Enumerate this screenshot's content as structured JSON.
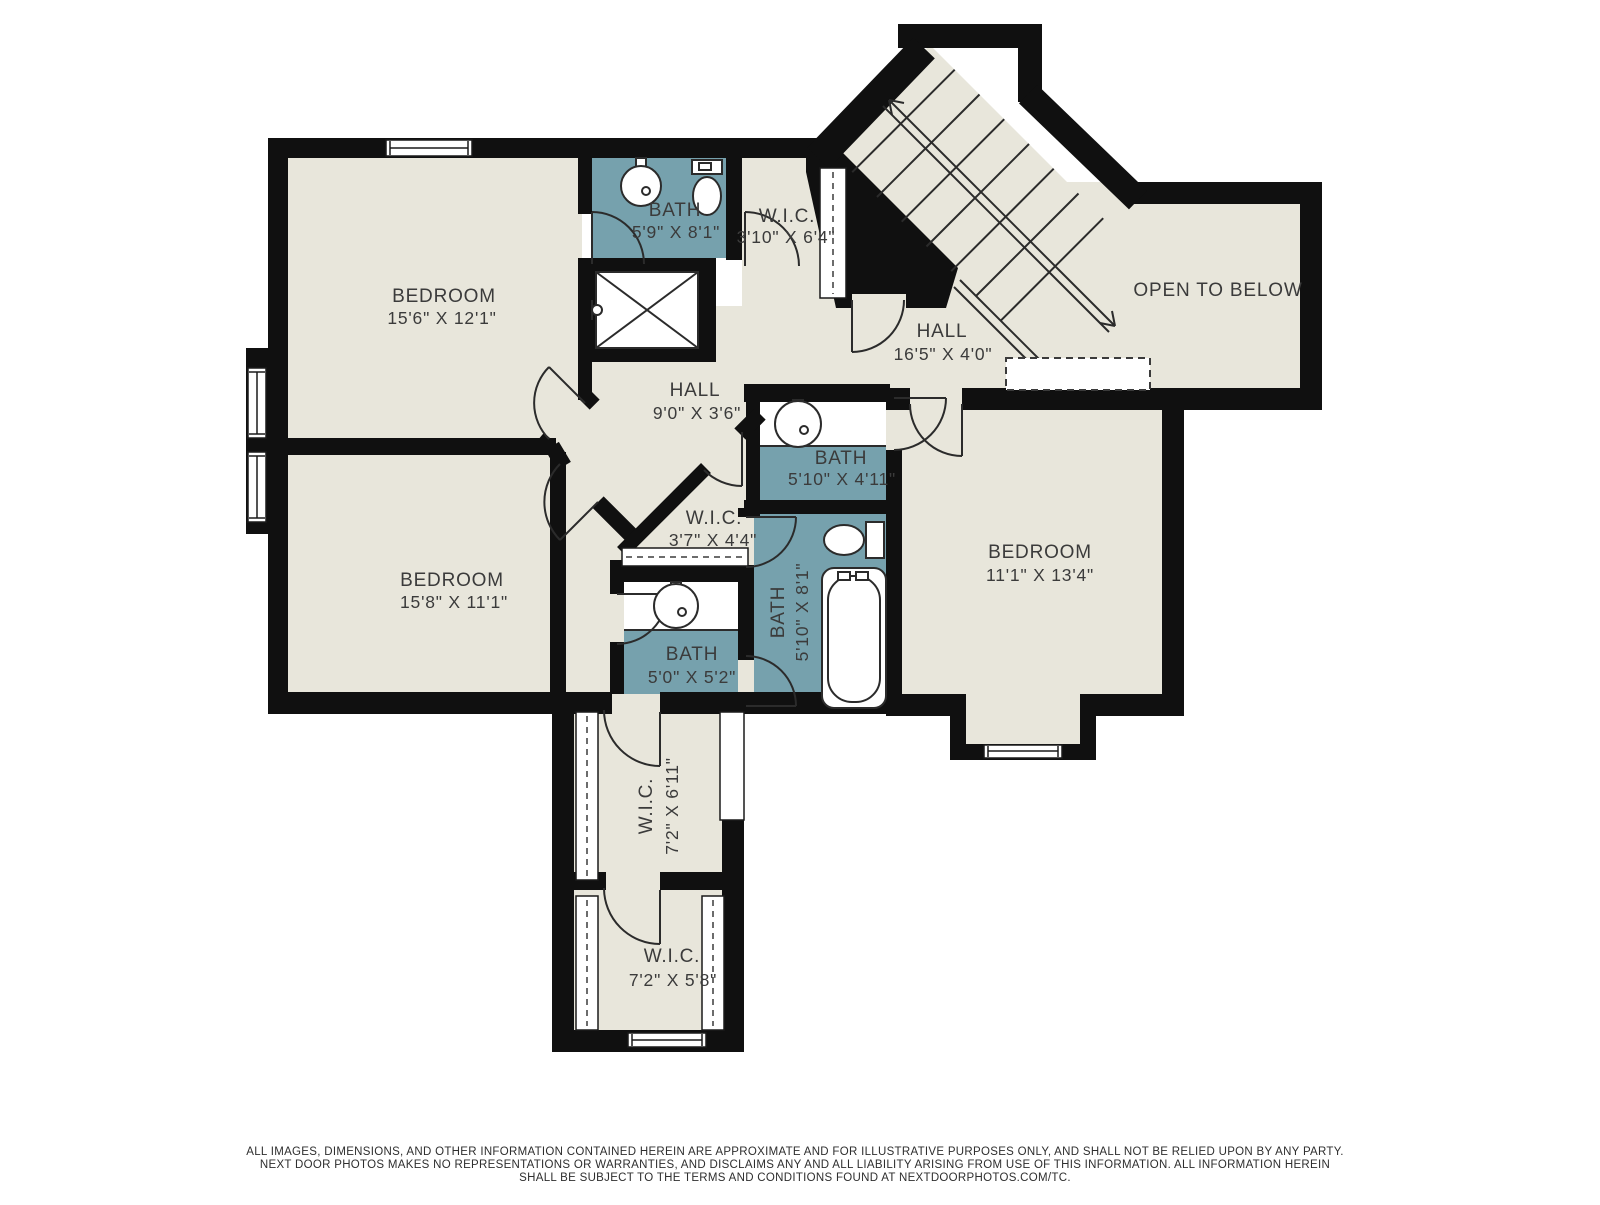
{
  "colors": {
    "background": "#ffffff",
    "room_fill": "#e8e6db",
    "bath_fill": "#76a1ad",
    "wall": "#101010",
    "line": "#2b2b2b",
    "text": "#3b3b3b"
  },
  "rooms": {
    "bedroom_tl": {
      "name": "BEDROOM",
      "dims": "15'6\" X 12'1\""
    },
    "bedroom_bl": {
      "name": "BEDROOM",
      "dims": "15'8\" X 11'1\""
    },
    "bedroom_r": {
      "name": "BEDROOM",
      "dims": "11'1\" X 13'4\""
    },
    "bath_top": {
      "name": "BATH",
      "dims": "5'9\" X 8'1\""
    },
    "bath_mid": {
      "name": "BATH",
      "dims": "5'10\" X 4'11\""
    },
    "bath_small": {
      "name": "BATH",
      "dims": "5'0\" X 5'2\""
    },
    "bath_long": {
      "name": "BATH",
      "dims": "5'10\" X 8'1\""
    },
    "wic_top": {
      "name": "W.I.C.",
      "dims": "3'10\" X 6'4\""
    },
    "wic_center": {
      "name": "W.I.C.",
      "dims": "3'7\" X 4'4\""
    },
    "wic_mid": {
      "name": "W.I.C.",
      "dims": "7'2\" X 6'11\""
    },
    "wic_bottom": {
      "name": "W.I.C.",
      "dims": "7'2\" X 5'8\""
    },
    "hall_center": {
      "name": "HALL",
      "dims": "9'0\" X 3'6\""
    },
    "hall_upper": {
      "name": "HALL",
      "dims": "16'5\" X 4'0\""
    },
    "open_to_below": {
      "name": "OPEN TO BELOW"
    }
  },
  "stairs": {
    "note": "staircase with up/down direction arrows"
  },
  "footer": {
    "line1": "ALL IMAGES, DIMENSIONS, AND OTHER INFORMATION CONTAINED HEREIN ARE APPROXIMATE AND FOR ILLUSTRATIVE PURPOSES ONLY, AND SHALL NOT BE RELIED UPON BY ANY PARTY.",
    "line2": "NEXT DOOR PHOTOS MAKES NO REPRESENTATIONS OR WARRANTIES, AND DISCLAIMS ANY AND ALL LIABILITY ARISING FROM USE OF THIS INFORMATION. ALL INFORMATION HEREIN",
    "line3": "SHALL BE SUBJECT TO THE TERMS AND CONDITIONS FOUND AT NEXTDOORPHOTOS.COM/TC."
  }
}
